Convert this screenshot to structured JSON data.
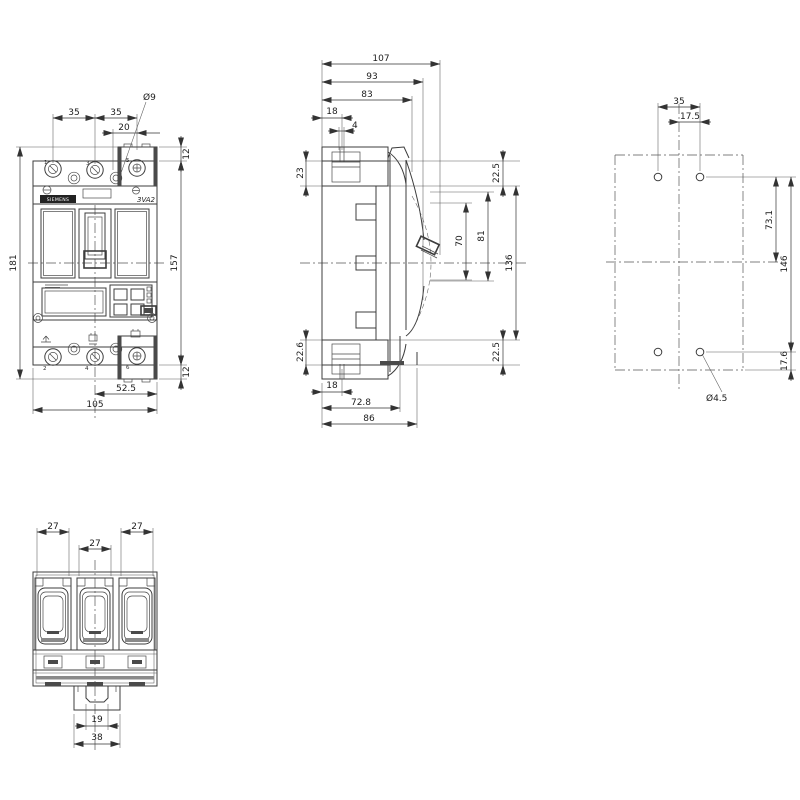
{
  "colors": {
    "background": "#ffffff",
    "line": "#3c3c3c",
    "dimension": "#333333",
    "badge": "#222222"
  },
  "front": {
    "dim_pole_pitch_left": "35",
    "dim_pole_pitch_right": "35",
    "dim_terminal_20": "20",
    "dia_terminal_hole": "Ø9",
    "dim_12_top": "12",
    "dim_overall_height": "181",
    "dim_body_height": "157",
    "dim_12_bottom": "12",
    "dim_half_width": "52.5",
    "dim_overall_width": "105",
    "brand": "SIEMENS",
    "model": "3VA2",
    "pole_numbers": {
      "p1": "1",
      "p3": "3",
      "p5": "5",
      "p2": "2",
      "p4": "4",
      "p6": "6"
    }
  },
  "side": {
    "dim_depth_overall": "107",
    "dim_depth_93": "93",
    "dim_depth_83": "83",
    "dim_18_top": "18",
    "dim_4": "4",
    "dim_23": "23",
    "dim_22_5_top": "22.5",
    "dim_70": "70",
    "dim_81": "81",
    "dim_136": "136",
    "dim_22_6": "22.6",
    "dim_18_bottom": "18",
    "dim_72_8": "72.8",
    "dim_86": "86",
    "dim_22_5_bottom": "22.5"
  },
  "mount": {
    "dim_hole_pitch": "35",
    "dim_17_5": "17.5",
    "dim_73_1": "73.1",
    "dim_146": "146",
    "dim_17_6": "17.6",
    "dia_mount_hole": "Ø4.5"
  },
  "bottom": {
    "dim_27_left": "27",
    "dim_27_mid": "27",
    "dim_27_right": "27",
    "dim_19": "19",
    "dim_38": "38"
  }
}
